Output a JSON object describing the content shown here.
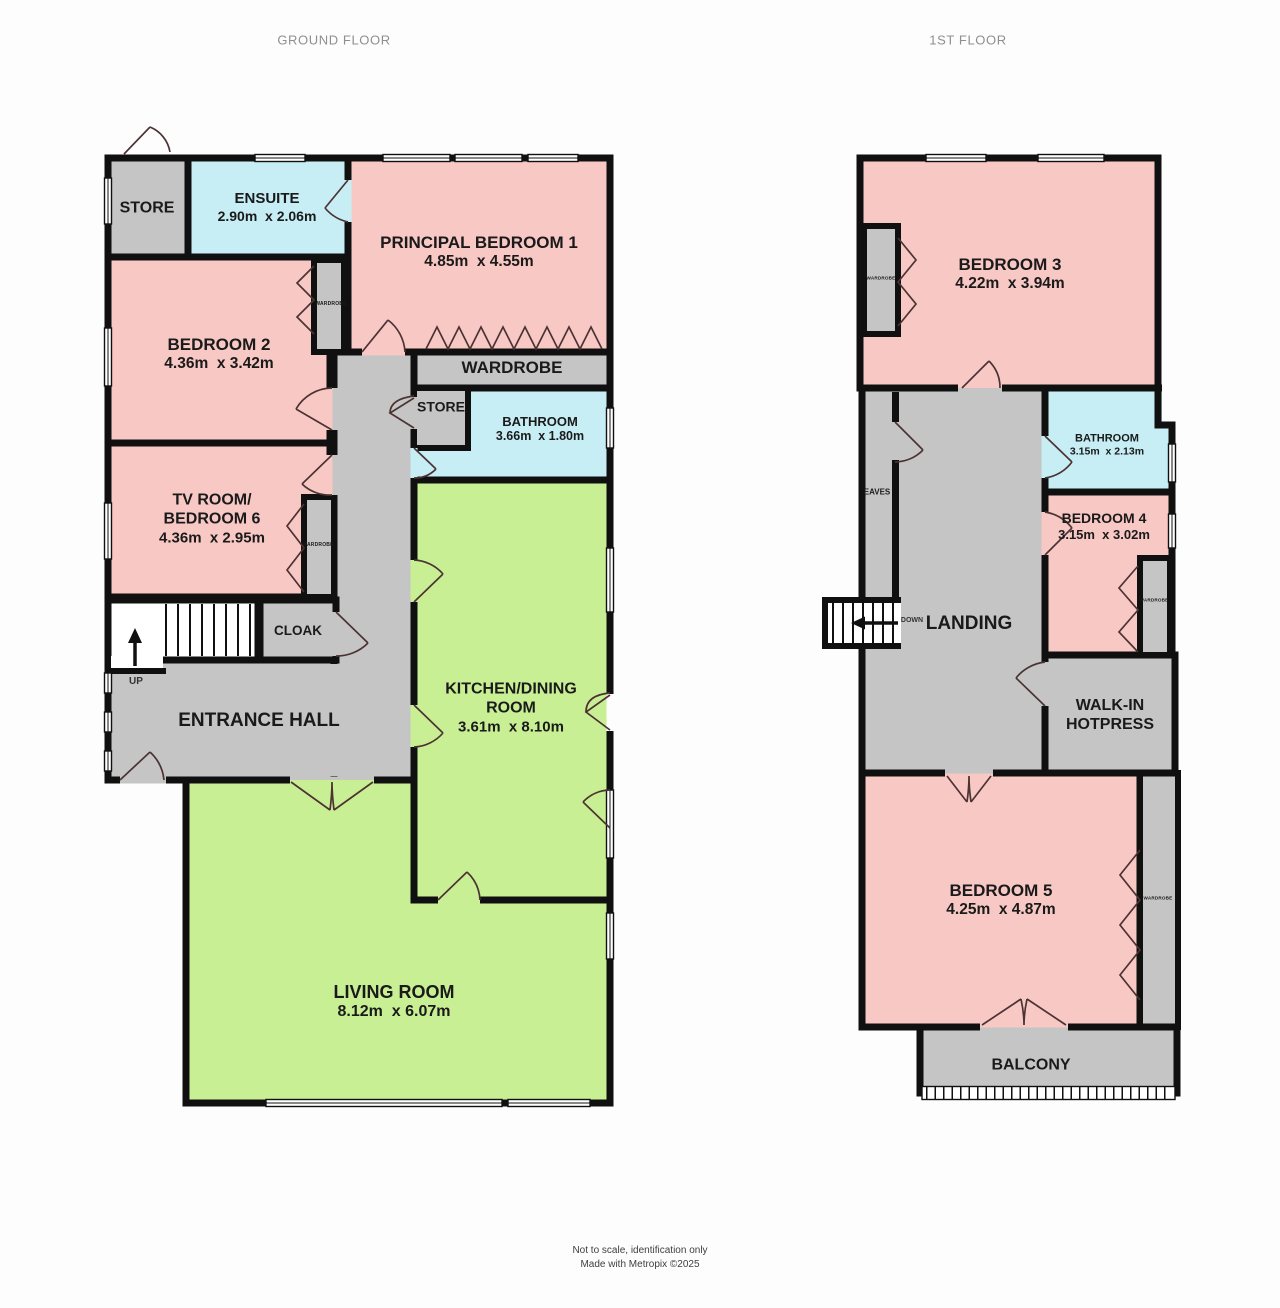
{
  "palette": {
    "wall": "#101010",
    "pink": "#f8c8c5",
    "cyan": "#c7eef5",
    "green": "#c9ef94",
    "gray": "#c5c5c5",
    "bg": "#fdfdfd",
    "text": "#1a1a1a",
    "title_text": "#8f8f8f",
    "footer_text": "#3f3f3f"
  },
  "titles": {
    "ground": "GROUND FLOOR",
    "first": "1ST FLOOR"
  },
  "ground_floor": {
    "store_top": {
      "name": "STORE"
    },
    "ensuite": {
      "name": "ENSUITE",
      "dims": "2.90m  x 2.06m"
    },
    "principal_bedroom_1": {
      "name": "PRINCIPAL BEDROOM 1",
      "dims": "4.85m  x 4.55m"
    },
    "bedroom_2": {
      "name": "BEDROOM 2",
      "dims": "4.36m  x 3.42m"
    },
    "wardrobe_bedroom_2": {
      "name": "WARDROBE"
    },
    "wardrobe_band": {
      "name": "WARDROBE"
    },
    "store_mid": {
      "name": "STORE"
    },
    "bathroom": {
      "name": "BATHROOM",
      "dims": "3.66m  x 1.80m"
    },
    "tv_room": {
      "name": "TV ROOM/\nBEDROOM 6",
      "dims": "4.36m  x 2.95m"
    },
    "wardrobe_tv_room": {
      "name": "WARDROBE"
    },
    "cloak": {
      "name": "CLOAK"
    },
    "stairs": {
      "label": "UP"
    },
    "entrance_hall": {
      "name": "ENTRANCE HALL"
    },
    "kitchen_dining": {
      "name": "KITCHEN/DINING\nROOM",
      "dims": "3.61m  x 8.10m"
    },
    "living_room": {
      "name": "LIVING ROOM",
      "dims": "8.12m  x 6.07m"
    }
  },
  "first_floor": {
    "bedroom_3": {
      "name": "BEDROOM 3",
      "dims": "4.22m  x 3.94m"
    },
    "wardrobe_bedroom_3": {
      "name": "WARDROBE"
    },
    "bathroom": {
      "name": "BATHROOM",
      "dims": "3.15m  x 2.13m"
    },
    "bedroom_4": {
      "name": "BEDROOM 4",
      "dims": "3.15m  x 3.02m"
    },
    "wardrobe_bedroom_4": {
      "name": "WARDROBE"
    },
    "eaves": {
      "name": "EAVES"
    },
    "stairs": {
      "label": "DOWN"
    },
    "landing": {
      "name": "LANDING"
    },
    "walk_in_hotpress": {
      "name": "WALK-IN\nHOTPRESS"
    },
    "bedroom_5": {
      "name": "BEDROOM 5",
      "dims": "4.25m  x 4.87m"
    },
    "wardrobe_bedroom_5": {
      "name": "WARDROBE"
    },
    "balcony": {
      "name": "BALCONY"
    }
  },
  "footer": {
    "line1": "Not to scale, identification only",
    "line2": "Made with Metropix ©2025"
  }
}
